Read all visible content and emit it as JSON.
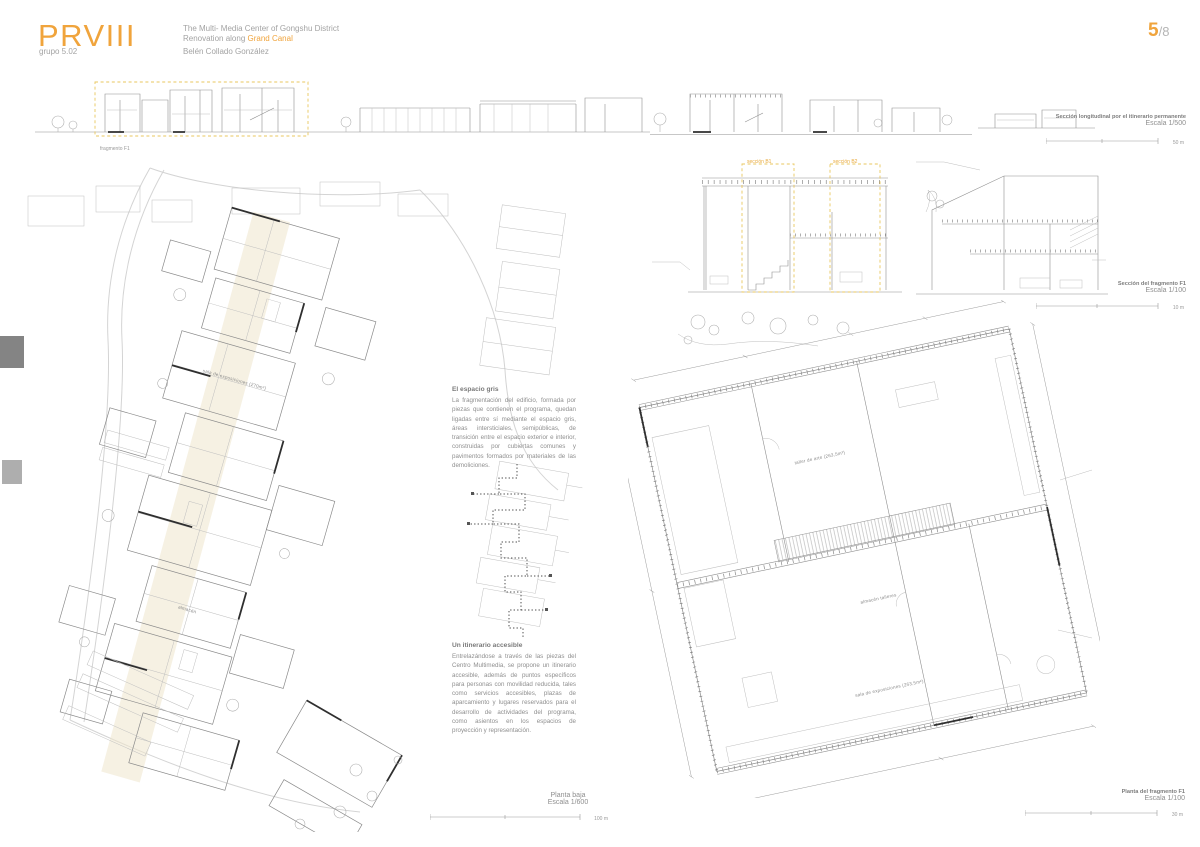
{
  "accent": "#f0a43c",
  "header": {
    "logo": "PRVIII",
    "title_line1": "The Multi- Media Center of Gongshu District",
    "title_line2_prefix": "Renovation along ",
    "title_line2_accent": "Grand Canal",
    "group_label": "grupo  5.02",
    "author": "Belén Collado González",
    "page_number": "5",
    "page_total": "/8"
  },
  "tags": {
    "fragment": "fragmento F1",
    "section_b1": "sección B1",
    "section_b2": "sección B2"
  },
  "captions": {
    "long_section": {
      "title": "Sección longitudinal por el itinerario permanente",
      "scale": "Escala 1/500",
      "bar": "50 m"
    },
    "fragment_section": {
      "title": "Sección del fragmento F1",
      "scale": "Escala 1/100",
      "bar": "10 m"
    },
    "ground_plan": {
      "title": "Planta baja",
      "scale": "Escala 1/600",
      "bar": "100 m"
    },
    "fragment_plan": {
      "title": "Planta del fragmento F1",
      "scale": "Escala 1/100",
      "bar": "30 m"
    }
  },
  "texts": {
    "gray_space": {
      "heading": "El espacio gris",
      "body": "La fragmentación del edificio, formada por piezas que contienen el programa, quedan ligadas entre sí mediante el espacio gris, áreas intersticiales, semipúblicas, de transición entre el espacio exterior e interior, construidas por cubiertas comunes y pavimentos formados por materiales de las demoliciones."
    },
    "accessible_route": {
      "heading": "Un itinerario accesible",
      "body": "Entrelazándose a través de las piezas del Centro Multimedia, se propone un itinerario accesible, además de puntos específicos para personas con movilidad reducida, tales como servicios accesibles, plazas de aparcamiento y lugares reservados para el desarrollo de actividades del programa, como asientos en los espacios de proyección y representación."
    }
  },
  "plan_labels": {
    "left_1": "sala de exposiciones (270m²)",
    "left_2": "almacén",
    "right_1": "taller de arte (263,5m²)",
    "right_2": "almacén talleres",
    "right_3": "sala de exposiciones (263,5m²)"
  }
}
